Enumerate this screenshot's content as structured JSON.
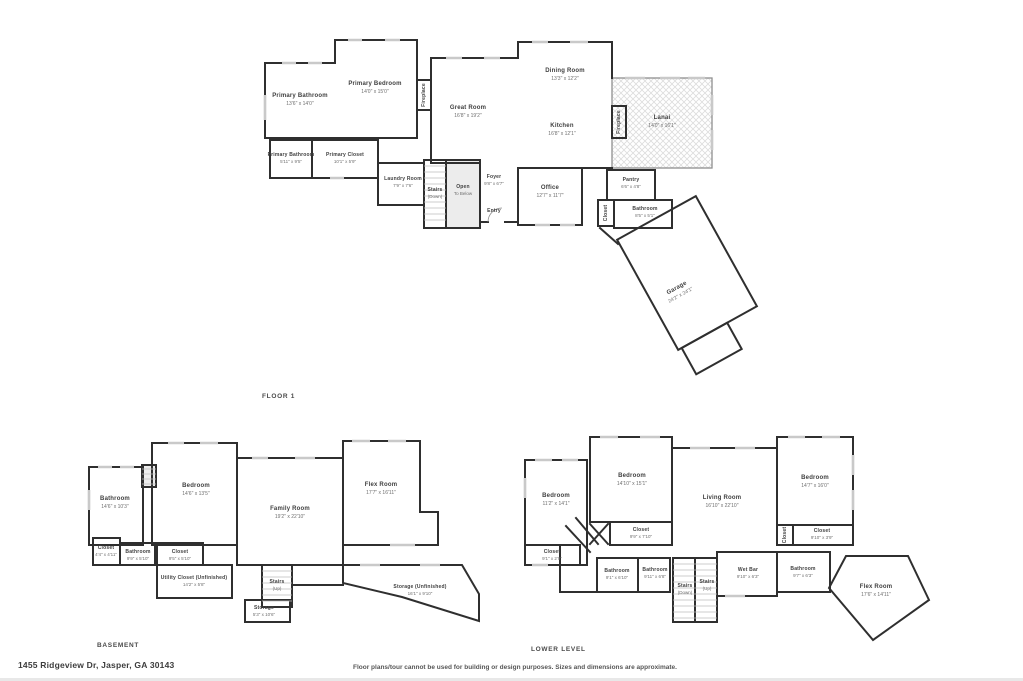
{
  "meta": {
    "address": "1455 Ridgeview Dr, Jasper, GA 30143",
    "disclaimer": "Floor plans/tour cannot be used for building or design purposes. Sizes and dimensions are approximate."
  },
  "colors": {
    "wall": "#2f2f2f",
    "window": "#c9c9c9",
    "shade": "#ececec",
    "hatch": "#dcdcdc"
  },
  "floor1": {
    "caption": "FLOOR 1",
    "rooms": {
      "primary_bathroom": {
        "name": "Primary Bathroom",
        "dims": "13'6\" x 14'0\""
      },
      "primary_bedroom": {
        "name": "Primary Bedroom",
        "dims": "14'0\" x 15'0\""
      },
      "fireplace_left": {
        "name": "Fireplace"
      },
      "great_room": {
        "name": "Great Room",
        "dims": "16'8\" x 19'2\""
      },
      "dining_room": {
        "name": "Dining Room",
        "dims": "13'3\" x 12'2\""
      },
      "kitchen": {
        "name": "Kitchen",
        "dims": "16'8\" x 12'1\""
      },
      "fireplace_right": {
        "name": "Fireplace"
      },
      "lanai": {
        "name": "Lanai",
        "dims": "14'0\" x 16'1\""
      },
      "primary_bathroom_2": {
        "name": "Primary Bathroom",
        "dims": "5'11\" x 9'5\""
      },
      "primary_closet": {
        "name": "Primary Closet",
        "dims": "10'1\" x 5'9\""
      },
      "laundry_room": {
        "name": "Laundry Room",
        "dims": "7'9\" x 7'6\""
      },
      "stairs_down": {
        "name": "Stairs",
        "sub": "(Down)"
      },
      "open_to_below": {
        "name": "Open",
        "sub": "To Below"
      },
      "foyer": {
        "name": "Foyer",
        "dims": "9'8\" x 6'7\""
      },
      "entry": {
        "name": "Entry"
      },
      "office": {
        "name": "Office",
        "dims": "12'7\" x 11'7\""
      },
      "pantry": {
        "name": "Pantry",
        "dims": "6'6\" x 4'8\""
      },
      "closet": {
        "name": "Closet"
      },
      "bathroom": {
        "name": "Bathroom",
        "dims": "8'5\" x 5'1\""
      },
      "garage": {
        "name": "Garage",
        "dims": "24'2\" x 24'1\""
      }
    }
  },
  "basement": {
    "caption": "BASEMENT",
    "rooms": {
      "bathroom_1": {
        "name": "Bathroom",
        "dims": "14'6\" x 10'3\""
      },
      "bedroom": {
        "name": "Bedroom",
        "dims": "14'6\" x 13'5\""
      },
      "family_room": {
        "name": "Family Room",
        "dims": "19'2\" x 22'10\""
      },
      "flex_room": {
        "name": "Flex Room",
        "dims": "17'7\" x 16'11\""
      },
      "closet_1": {
        "name": "Closet",
        "dims": "4'4\" x 4'11\""
      },
      "bathroom_2": {
        "name": "Bathroom",
        "dims": "9'9\" x 5'10\""
      },
      "closet_2": {
        "name": "Closet",
        "dims": "9'5\" x 5'10\""
      },
      "utility_closet": {
        "name": "Utility Closet (Unfinished)",
        "dims": "14'2\" x 5'8\""
      },
      "stairs_up": {
        "name": "Stairs",
        "sub": "(Up)"
      },
      "storage": {
        "name": "Storage",
        "dims": "5'3\" x 10'6\""
      },
      "storage_unfinished": {
        "name": "Storage (Unfinished)",
        "dims": "16'1\" x 9'10\""
      }
    }
  },
  "lower": {
    "caption": "LOWER LEVEL",
    "rooms": {
      "bedroom_left": {
        "name": "Bedroom",
        "dims": "11'2\" x 14'1\""
      },
      "bedroom_center": {
        "name": "Bedroom",
        "dims": "14'10\" x 15'1\""
      },
      "living_room": {
        "name": "Living Room",
        "dims": "16'10\" x 22'10\""
      },
      "bedroom_right": {
        "name": "Bedroom",
        "dims": "14'7\" x 16'0\""
      },
      "closet_left": {
        "name": "Closet",
        "dims": "9'1\" x 2'9\""
      },
      "closet_center": {
        "name": "Closet",
        "dims": "9'9\" x 7'10\""
      },
      "closet_small": {
        "name": "Closet"
      },
      "closet_right": {
        "name": "Closet",
        "dims": "9'10\" x 3'9\""
      },
      "bathroom_1": {
        "name": "Bathroom",
        "dims": "9'1\" x 6'10\""
      },
      "bathroom_2": {
        "name": "Bathroom",
        "dims": "9'11\" x 6'8\""
      },
      "stairs_down": {
        "name": "Stairs",
        "sub": "(Down)"
      },
      "stairs_up": {
        "name": "Stairs",
        "sub": "(Up)"
      },
      "wet_bar": {
        "name": "Wet Bar",
        "dims": "9'10\" x 6'3\""
      },
      "bathroom_3": {
        "name": "Bathroom",
        "dims": "9'7\" x 6'3\""
      },
      "flex_room": {
        "name": "Flex Room",
        "dims": "17'6\" x 14'11\""
      }
    }
  }
}
